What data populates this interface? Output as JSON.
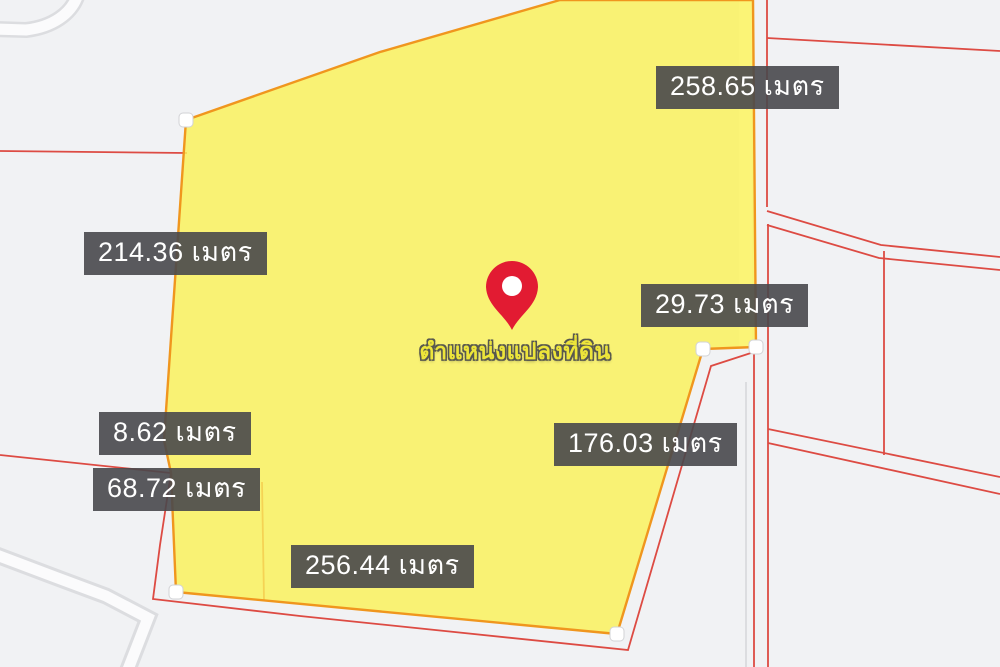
{
  "map": {
    "caption": "ตำแหน่งแปลงที่ดิน",
    "unit": "เมตร",
    "measurements": [
      {
        "label": "258.65 เมตร",
        "value": 258.65,
        "side": "right-upper"
      },
      {
        "label": "214.36 เมตร",
        "value": 214.36,
        "side": "left-upper"
      },
      {
        "label": "29.73 เมตร",
        "value": 29.73,
        "side": "right-middle"
      },
      {
        "label": "8.62 เมตร",
        "value": 8.62,
        "side": "left-lower"
      },
      {
        "label": "68.72 เมตร",
        "value": 68.72,
        "side": "left-lower"
      },
      {
        "label": "176.03 เมตร",
        "value": 176.03,
        "side": "right-lower"
      },
      {
        "label": "256.44 เมตร",
        "value": 256.44,
        "side": "bottom"
      }
    ],
    "colors": {
      "background": "#F1F2F4",
      "parcel_fill": "#FAF158",
      "parcel_stroke": "#F0961E",
      "boundary_line": "#DD4B43",
      "road_line": "#DCDDE0",
      "label_background": "#48484C",
      "label_text": "#FFFFFF",
      "caption_text": "#EDE53A",
      "pin": "#E21B32",
      "vertex_marker": "#FFFFFF"
    }
  }
}
